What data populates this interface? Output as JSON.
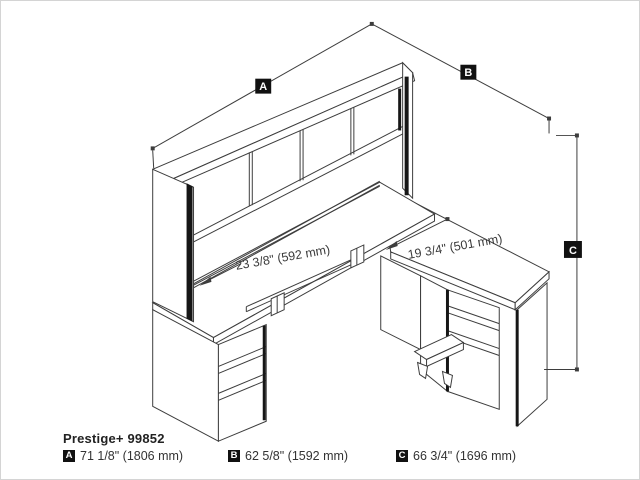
{
  "product": {
    "name": "Prestige+ 99852"
  },
  "dimensions": {
    "a": {
      "key": "A",
      "value": "71 1/8\" (1806 mm)"
    },
    "b": {
      "key": "B",
      "value": "62 5/8\" (1592 mm)"
    },
    "c": {
      "key": "C",
      "value": "66 3/4\" (1696 mm)"
    }
  },
  "annotations": {
    "desk_depth": "23 3/8\" (592 mm)",
    "return_depth": "19 3/4\" (501 mm)"
  },
  "colors": {
    "line": "#3d3d3d",
    "accent": "#161616",
    "background": "#ffffff",
    "badge_bg": "#111111",
    "badge_text": "#ffffff"
  }
}
